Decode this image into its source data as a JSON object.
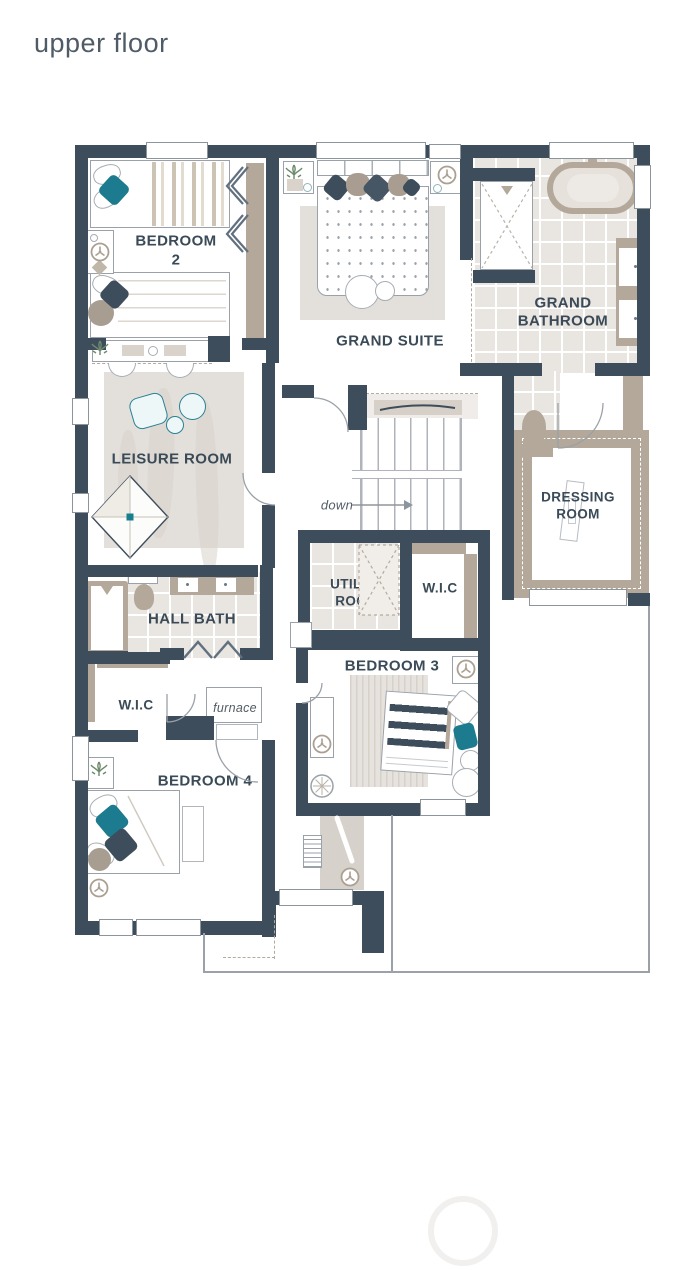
{
  "title": "upper floor",
  "rooms": {
    "bedroom2": {
      "label_line1": "BEDROOM",
      "label_line2": "2"
    },
    "grand_suite": {
      "label": "GRAND SUITE"
    },
    "grand_bathroom": {
      "label_line1": "GRAND",
      "label_line2": "BATHROOM"
    },
    "leisure_room": {
      "label": "LEISURE ROOM"
    },
    "dressing_room": {
      "label_line1": "DRESSING",
      "label_line2": "ROOM"
    },
    "utility_room": {
      "label_line1": "UTILITY",
      "label_line2": "ROOM"
    },
    "wic_middle": {
      "label": "W.I.C"
    },
    "hall_bath": {
      "label": "HALL BATH"
    },
    "wic_bedroom4": {
      "label": "W.I.C"
    },
    "bedroom3": {
      "label": "BEDROOM 3"
    },
    "bedroom4": {
      "label": "BEDROOM 4"
    }
  },
  "annotations": {
    "stairs_direction": "down",
    "furnace": "furnace"
  },
  "icons": [
    "ceiling-fan-icon",
    "plant-icon",
    "shower-head-icon",
    "down-arrow-icon"
  ],
  "colors": {
    "wall": "#3e4d5b",
    "accent_teal": "#1d7b8f",
    "taupe": "#b3a89a",
    "tile": "#e9e5e0",
    "label_text": "#3a4a57",
    "rug": "#e3e0db",
    "outline": "#9aa1a8"
  }
}
